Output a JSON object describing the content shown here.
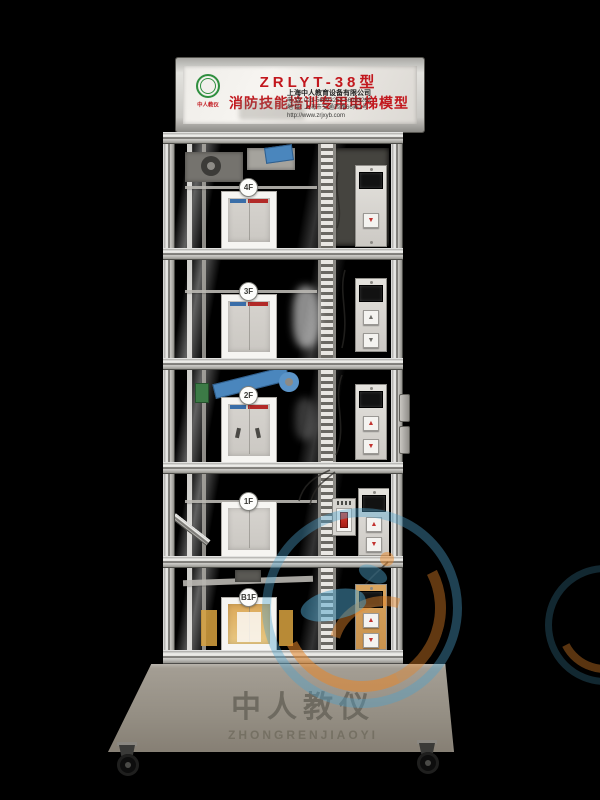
{
  "sign": {
    "model": "ZRLYT-38型",
    "title": "消防技能培训专用电梯模型",
    "logo_text": "中人教仪",
    "company": "上海中人教育设备有限公司",
    "phone": "电 话: 021-56093252  56093262",
    "address": "地 址: 上海市交通西路66弄1号",
    "website": "http://www.zrjxyb.com"
  },
  "icons": {
    "up_arrow": "▲",
    "down_arrow": "▼"
  },
  "floors": [
    {
      "label": "4F",
      "panel_buttons": [
        "down"
      ]
    },
    {
      "label": "3F",
      "panel_buttons": [
        "up",
        "down"
      ]
    },
    {
      "label": "2F",
      "panel_buttons": [
        "up",
        "down"
      ]
    },
    {
      "label": "1F",
      "panel_buttons": [
        "up",
        "down"
      ],
      "fire_switch": true
    },
    {
      "label": "B1F",
      "panel_buttons": [
        "up",
        "down"
      ]
    }
  ],
  "base": {
    "brand_cn": "中人教仪",
    "brand_en": "ZHONGRENJIAOYI"
  },
  "colors": {
    "title_red": "#c2171d",
    "logo_green": "#2f8f3f",
    "watermark_blue": "#4da3cc",
    "watermark_orange": "#e8872a",
    "frame_silver": "#d8d7d3",
    "base_gray": "#958f84",
    "door_strip_blue": "#3a6ea8",
    "door_strip_red": "#b22a28"
  }
}
